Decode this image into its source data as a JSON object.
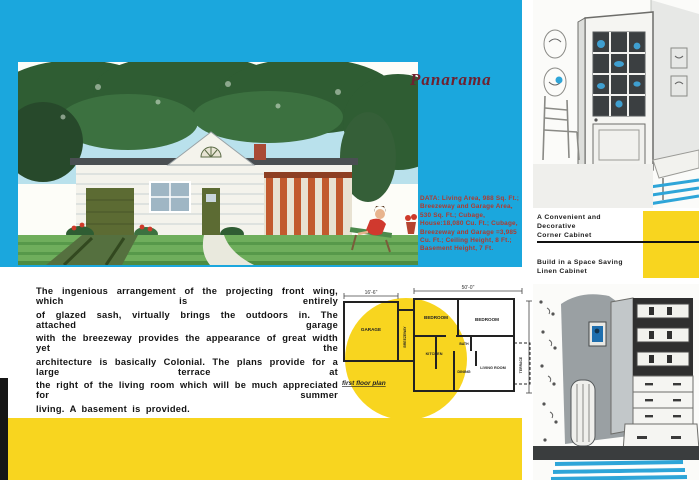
{
  "left_page": {
    "title": "Panarama",
    "data_text": "DATA: Living Area, 988 Sq. Ft.; Breezeway and Garage Area, 530 Sq. Ft.; Cubage, House:18,080 Cu. Ft.; Cubage, Breezeway and Garage =3,985 Cu. Ft.; Ceiling Height, 8 Ft.; Basement Height, 7 Ft.",
    "description_lines": [
      "The ingenious arrangement of the projecting front wing, which is entirely",
      "of glazed sash, virtually brings the outdoors in. The attached garage",
      "with the breezeway provides the appearance of great width yet the",
      "architecture is basically Colonial. The plans provide for a large terrace at",
      "the right of the living room which will be much appreciated for summer",
      "living. A basement is provided."
    ]
  },
  "floor_plan": {
    "caption": "first floor plan",
    "dim_garage_width": "16'-6\"",
    "dim_house_width": "50'-0\"",
    "dim_house_depth": "30'-0\"",
    "rooms": {
      "garage": "GARAGE",
      "breezeway": "BREEZEWAY",
      "bedroom1": "BEDROOM",
      "bedroom2": "BEDROOM",
      "bath": "BATH",
      "kitchen": "KITCHEN",
      "dining": "DINING",
      "living_room": "LIVING ROOM",
      "terrace": "TERRACE"
    }
  },
  "right_page": {
    "caption_top_line1": "A Convenient and Decorative",
    "caption_top_line2": "Corner Cabinet",
    "caption_bottom_line1": "Build in a Space Saving",
    "caption_bottom_line2": "Linen Cabinet"
  },
  "colors": {
    "cyan": "#1ba7dd",
    "yellow": "#f8d51f",
    "title_red": "#6d2230",
    "data_red": "#b03a2e"
  }
}
